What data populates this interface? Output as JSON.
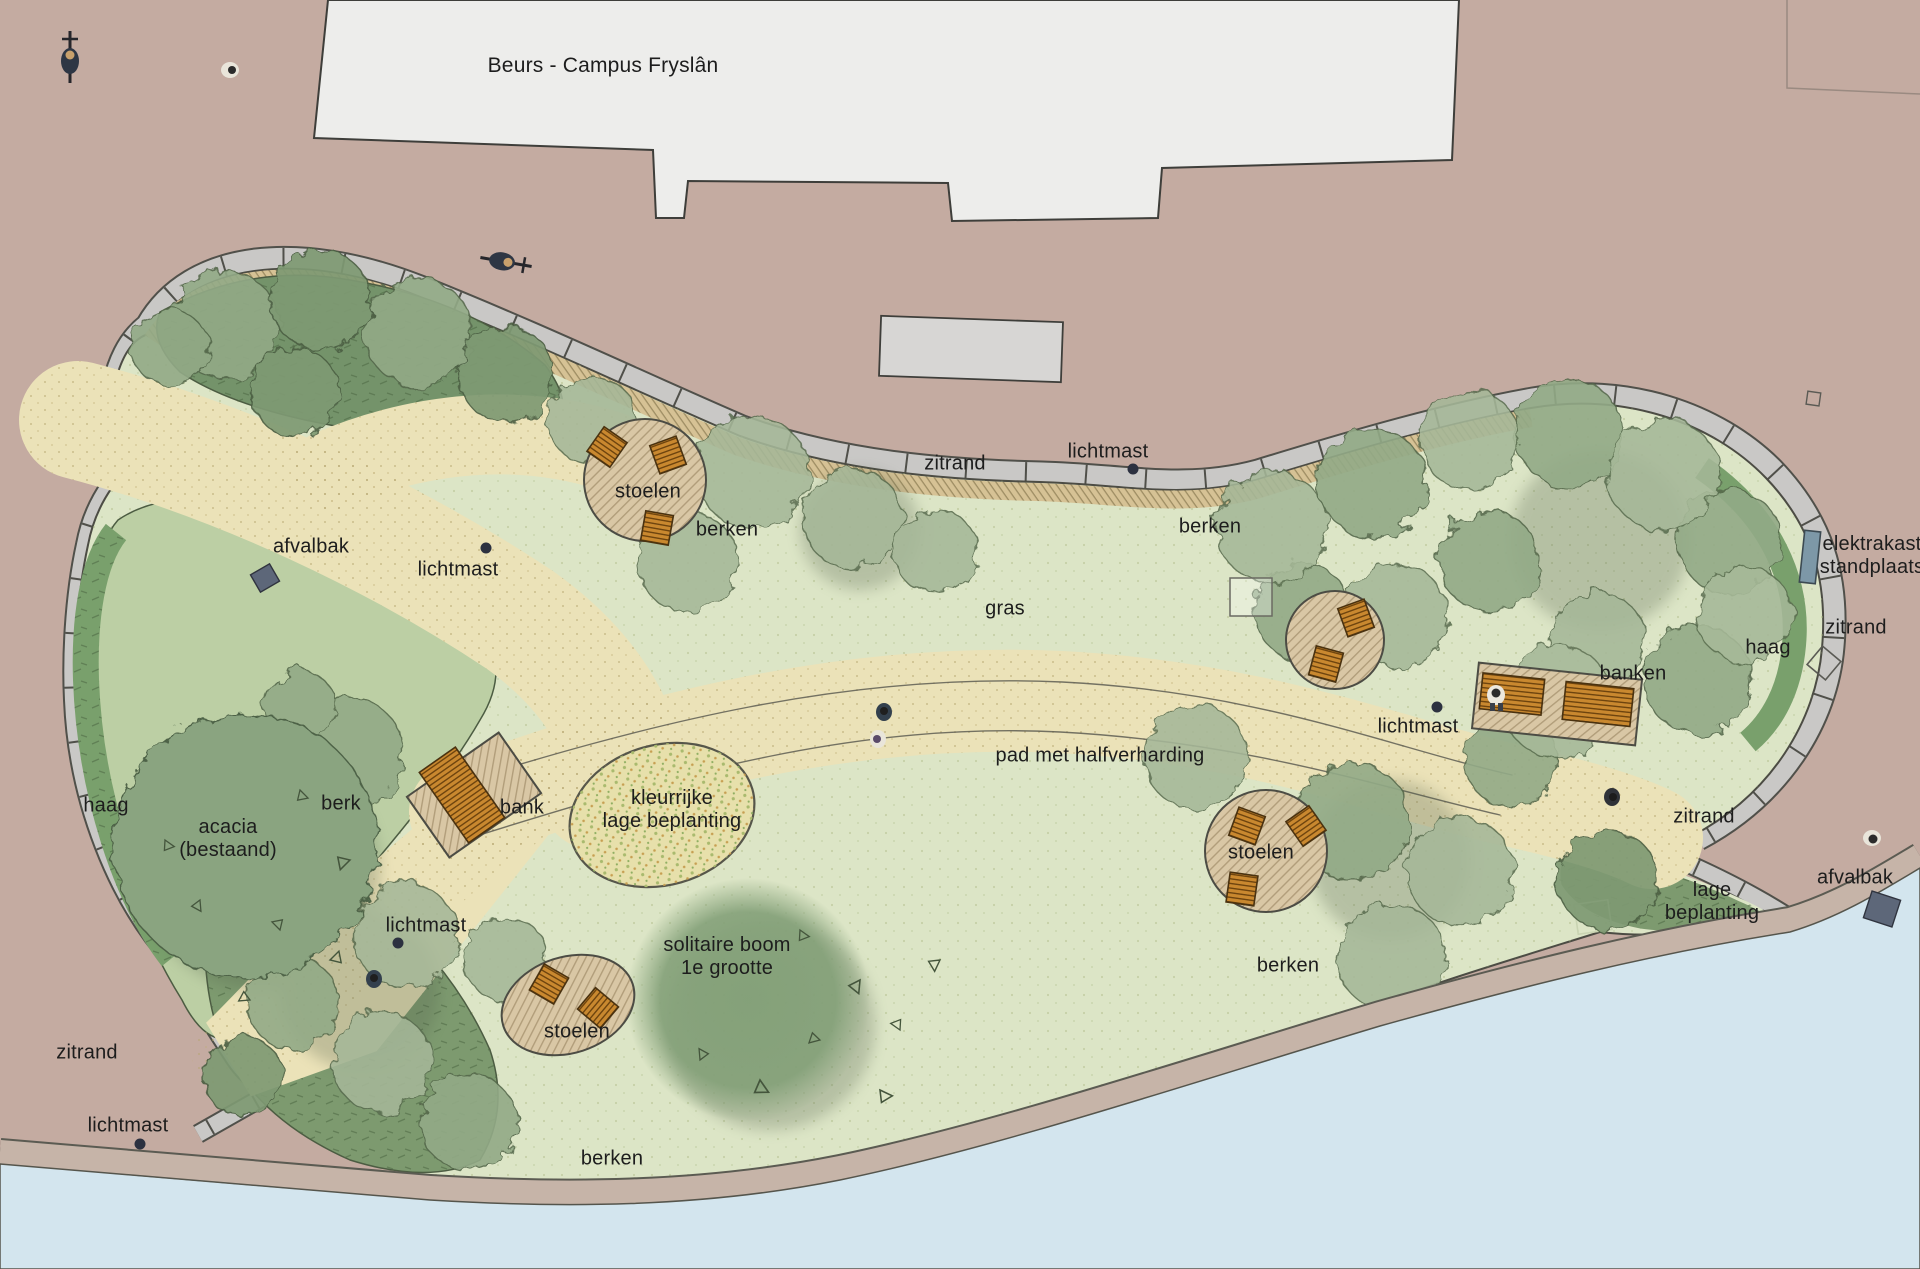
{
  "plan": {
    "title": "Beurs - Campus Fryslân",
    "type": "landscape-site-plan",
    "labels": [
      {
        "id": "building-title",
        "text": "Beurs - Campus Fryslân",
        "x": 603,
        "y": 66,
        "big": true
      },
      {
        "id": "zitrand-north",
        "text": "zitrand",
        "x": 955,
        "y": 464
      },
      {
        "id": "lichtmast-north",
        "text": "lichtmast",
        "x": 1108,
        "y": 452
      },
      {
        "id": "berken-northeast",
        "text": "berken",
        "x": 1210,
        "y": 527
      },
      {
        "id": "stoelen-northwest",
        "text": "stoelen",
        "x": 648,
        "y": 492
      },
      {
        "id": "berken-northwest",
        "text": "berken",
        "x": 727,
        "y": 530
      },
      {
        "id": "afvalbak-west",
        "text": "afvalbak",
        "x": 311,
        "y": 547
      },
      {
        "id": "lichtmast-west",
        "text": "lichtmast",
        "x": 458,
        "y": 570
      },
      {
        "id": "gras",
        "text": "gras",
        "x": 1005,
        "y": 609
      },
      {
        "id": "elektrakast-standplaats",
        "text": "elektrakast\nstandplaats",
        "x": 1872,
        "y": 556
      },
      {
        "id": "zitrand-east",
        "text": "zitrand",
        "x": 1856,
        "y": 628
      },
      {
        "id": "haag-east",
        "text": "haag",
        "x": 1768,
        "y": 648
      },
      {
        "id": "banken",
        "text": "banken",
        "x": 1633,
        "y": 674
      },
      {
        "id": "lichtmast-center",
        "text": "lichtmast",
        "x": 1418,
        "y": 727
      },
      {
        "id": "pad-met-halfverharding",
        "text": "pad met halfverharding",
        "x": 1100,
        "y": 756
      },
      {
        "id": "haag-west",
        "text": "haag",
        "x": 106,
        "y": 806
      },
      {
        "id": "acacia-bestaand",
        "text": "acacia\n(bestaand)",
        "x": 228,
        "y": 839
      },
      {
        "id": "berk",
        "text": "berk",
        "x": 341,
        "y": 804
      },
      {
        "id": "bank",
        "text": "bank",
        "x": 522,
        "y": 808
      },
      {
        "id": "kleurrijke-lage-beplanting",
        "text": "kleurrijke\nlage beplanting",
        "x": 672,
        "y": 810
      },
      {
        "id": "zitrand-southeast",
        "text": "zitrand",
        "x": 1704,
        "y": 817
      },
      {
        "id": "stoelen-east",
        "text": "stoelen",
        "x": 1261,
        "y": 853
      },
      {
        "id": "lage-beplanting",
        "text": "lage\nbeplanting",
        "x": 1712,
        "y": 902
      },
      {
        "id": "afvalbak-east",
        "text": "afvalbak",
        "x": 1855,
        "y": 878
      },
      {
        "id": "lichtmast-path",
        "text": "lichtmast",
        "x": 426,
        "y": 926
      },
      {
        "id": "solitaire-boom",
        "text": "solitaire boom\n1e grootte",
        "x": 727,
        "y": 957
      },
      {
        "id": "berken-east",
        "text": "berken",
        "x": 1288,
        "y": 966
      },
      {
        "id": "stoelen-south",
        "text": "stoelen",
        "x": 577,
        "y": 1032
      },
      {
        "id": "zitrand-southwest",
        "text": "zitrand",
        "x": 87,
        "y": 1053
      },
      {
        "id": "lichtmast-southwest",
        "text": "lichtmast",
        "x": 128,
        "y": 1126
      },
      {
        "id": "berken-south",
        "text": "berken",
        "x": 612,
        "y": 1159
      }
    ],
    "colors": {
      "plaza": "#c4aba1",
      "building": "#ededeb",
      "building_annex": "#d7d6d4",
      "grass": "#dce5c6",
      "sand_path": "#ebe2b8",
      "water": "#d3e5ee",
      "shore": "#c6b4a8",
      "sitting_edge": "#c9c8c6",
      "tree_canopy": "#a6b898",
      "planting_bed": "#74936a",
      "hedge": "#79a06c",
      "furniture_wood": "#c9882f",
      "elektrakast": "#7d98a7",
      "afvalbak": "#5d6779",
      "colorful_planting": "#e7e0ab",
      "text": "#1d1d1d"
    },
    "features": {
      "seating_circles_with_chairs": 4,
      "chairs_total": 10,
      "bench_platforms": 2,
      "benches_total": 3,
      "lichtmast_dots": 5,
      "afvalbak_bins": 2,
      "elektrakast_cabinets": 1,
      "pedestrians": 7,
      "cyclists": 2
    }
  }
}
